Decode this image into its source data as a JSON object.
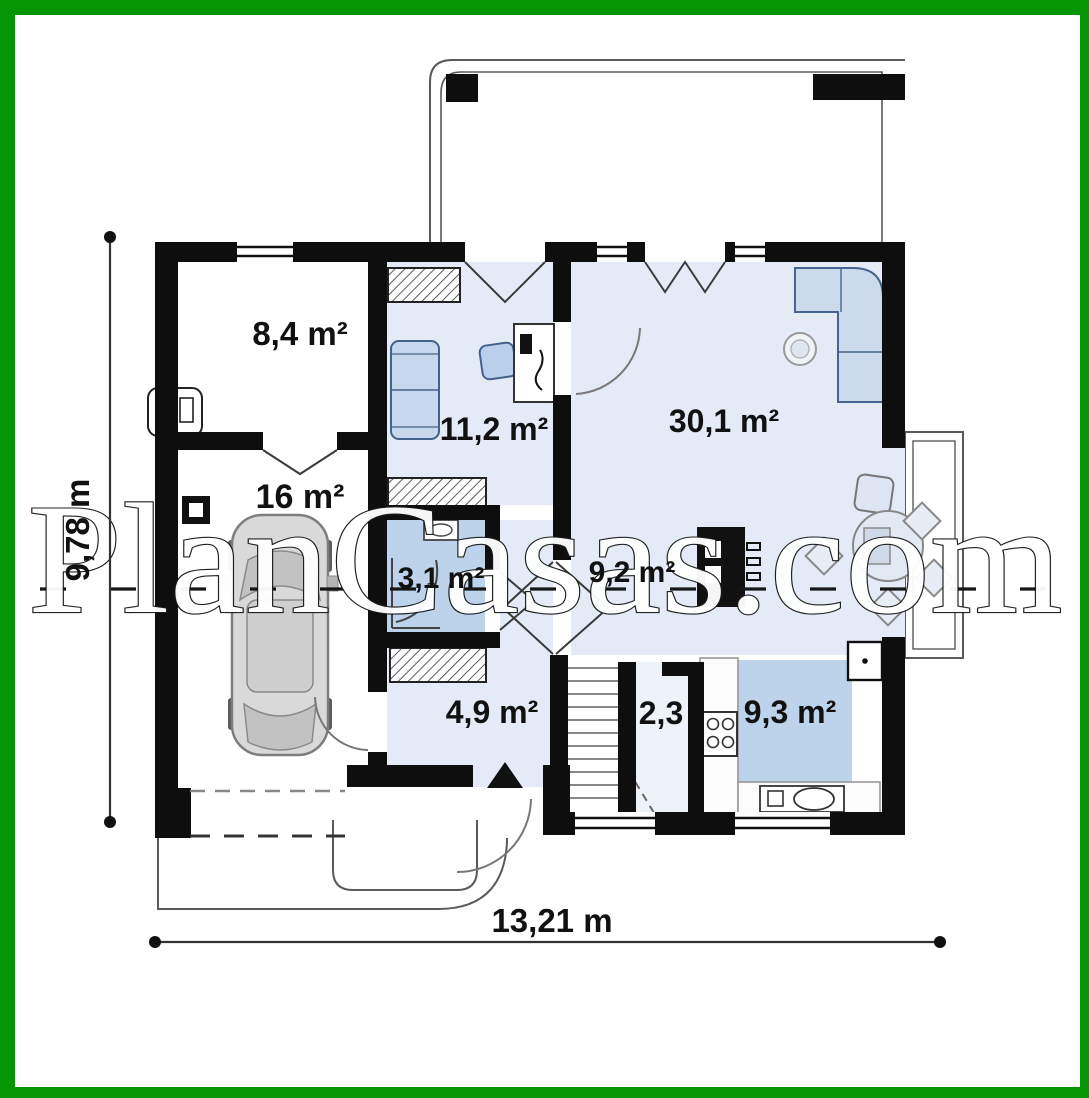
{
  "watermark_text": "PlanCasas.com",
  "rooms": [
    {
      "id": "storage-room",
      "label": "8,4 m²"
    },
    {
      "id": "garage",
      "label": "16 m²"
    },
    {
      "id": "bedroom",
      "label": "11,2 m²"
    },
    {
      "id": "living-room",
      "label": "30,1 m²"
    },
    {
      "id": "bathroom",
      "label": "3,1 m²"
    },
    {
      "id": "dining-area",
      "label": "9,2 m²"
    },
    {
      "id": "entry-hall",
      "label": "4,9 m²"
    },
    {
      "id": "stair-corridor",
      "label": "2,3"
    },
    {
      "id": "kitchen",
      "label": "9,3 m²"
    }
  ],
  "dimensions": {
    "height_label": "9,78 m",
    "width_label": "13,21 m"
  },
  "colors": {
    "border_green": "#049404",
    "wall_black": "#0e0e0e",
    "floor_light_blue": "#e4ebf6",
    "floor_mid_blue": "#bdd3ec",
    "corridor_blue": "#eef3fa",
    "furniture_blue": "#c7d8ee",
    "outline_gray": "#5a5a5a"
  }
}
